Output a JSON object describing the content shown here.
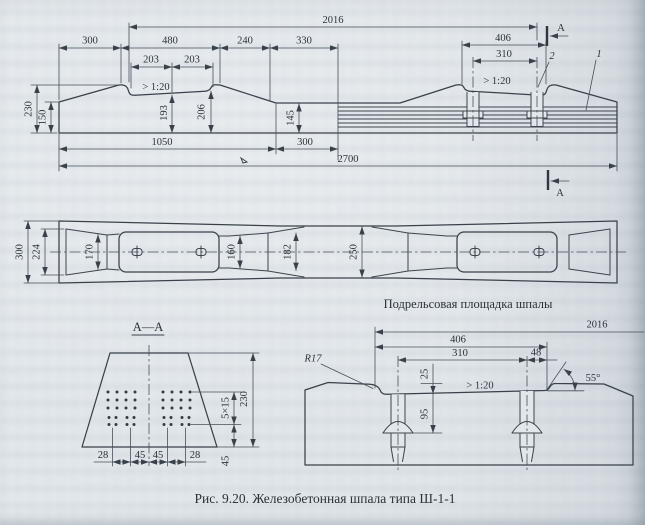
{
  "caption": "Рис. 9.20. Железобетонная шпала типа Ш-1-1",
  "labels": {
    "rail_pad_note": "Подрельсовая площадка шпалы",
    "section_title": "А—А",
    "section_mark_top": "А",
    "section_mark_bottom": "А",
    "part_1": "1",
    "part_2": "2"
  },
  "elevation": {
    "span": "2016",
    "top_chain": [
      "300",
      "480",
      "240",
      "330"
    ],
    "seat_half_left": "203",
    "seat_half_right": "203",
    "slope_left": "> 1:20",
    "slope_right": "> 1:20",
    "seat_width": "406",
    "dowel_spacing": "310",
    "height_shoulder": "230",
    "height_end": "150",
    "height_seat_mid": "193",
    "height_seat_edge": "206",
    "height_middle": "145",
    "bottom_left": "1050",
    "bottom_mid": "300",
    "overall": "2700"
  },
  "plan": {
    "width_end": "300",
    "width_end_top": "224",
    "waist": "170",
    "neck": "160",
    "mid_top": "182",
    "mid_base": "250"
  },
  "section": {
    "bottom_chain": [
      "28",
      "45",
      "45",
      "28"
    ],
    "wire_grid": "5×15",
    "height": "230",
    "bottom_offset": "45"
  },
  "detail": {
    "span": "2016",
    "seat_width": "406",
    "dowel_spacing": "310",
    "edge_offset": "48",
    "radius": "R17",
    "recess_depth": "25",
    "dowel_depth": "95",
    "angle": "55°",
    "slope": "> 1:20"
  }
}
